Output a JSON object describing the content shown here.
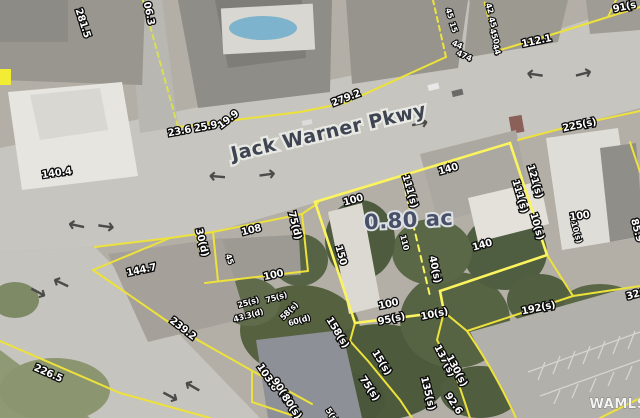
{
  "map": {
    "road_label": "Jack Warner Pkwy",
    "highlight_parcel": {
      "area_label": "0.80 ac"
    },
    "watermark": "WAMLS",
    "arrow_glyph": "→",
    "colors": {
      "parcel_line": "#EDE23B",
      "highlight_parcel_line": "#FBF45F",
      "area_text": "#475066",
      "road_text": "#3E4452",
      "dimension_text_fill": "#FFFFFF",
      "dimension_text_outline": "#0B0B0B"
    },
    "label_sizes": {
      "dim": 10,
      "dimsm": 8,
      "road": 19,
      "area": 21,
      "wm": 13
    },
    "labels": [
      {
        "t": "281.5",
        "x": 80,
        "y": 24,
        "r": 72,
        "k": "dim"
      },
      {
        "t": "06.3",
        "x": 146,
        "y": 14,
        "r": 78,
        "k": "dim"
      },
      {
        "t": "23.6 25.9",
        "x": 193,
        "y": 132,
        "r": -10,
        "k": "dim"
      },
      {
        "t": "19.9",
        "x": 230,
        "y": 122,
        "r": -38,
        "k": "dim"
      },
      {
        "t": "140.4",
        "x": 57,
        "y": 176,
        "r": -8,
        "k": "dim"
      },
      {
        "t": "279.2",
        "x": 347,
        "y": 101,
        "r": -21,
        "k": "dim"
      },
      {
        "t": "112.1",
        "x": 537,
        "y": 44,
        "r": -12,
        "k": "dim"
      },
      {
        "t": "91(s",
        "x": 625,
        "y": 10,
        "r": -12,
        "k": "dim"
      },
      {
        "t": "45",
        "x": 447,
        "y": 14,
        "r": 72,
        "k": "dimsm"
      },
      {
        "t": "15",
        "x": 451,
        "y": 28,
        "r": 72,
        "k": "dimsm"
      },
      {
        "t": "44",
        "x": 456,
        "y": 47,
        "r": 25,
        "k": "dimsm"
      },
      {
        "t": "474",
        "x": 463,
        "y": 58,
        "r": 25,
        "k": "dimsm"
      },
      {
        "t": "42",
        "x": 487,
        "y": 9,
        "r": 72,
        "k": "dimsm"
      },
      {
        "t": "45",
        "x": 490,
        "y": 23,
        "r": 72,
        "k": "dimsm"
      },
      {
        "t": "450",
        "x": 492,
        "y": 37,
        "r": 72,
        "k": "dimsm"
      },
      {
        "t": "44",
        "x": 494,
        "y": 50,
        "r": 72,
        "k": "dimsm"
      },
      {
        "t": "225(s)",
        "x": 580,
        "y": 128,
        "r": -12,
        "k": "dim"
      },
      {
        "t": "100",
        "x": 580,
        "y": 219,
        "r": -8,
        "k": "dim"
      },
      {
        "t": "85.9",
        "x": 634,
        "y": 231,
        "r": 75,
        "k": "dim"
      },
      {
        "t": "111(s)",
        "x": 407,
        "y": 192,
        "r": 74,
        "k": "dim"
      },
      {
        "t": "111(s)",
        "x": 517,
        "y": 197,
        "r": 74,
        "k": "dim"
      },
      {
        "t": "121(s)",
        "x": 532,
        "y": 182,
        "r": 74,
        "k": "dim"
      },
      {
        "t": "140",
        "x": 449,
        "y": 172,
        "r": -16,
        "k": "dim"
      },
      {
        "t": "100",
        "x": 354,
        "y": 203,
        "r": -16,
        "k": "dim"
      },
      {
        "t": "0.80 ac",
        "x": 409,
        "y": 227,
        "r": -3,
        "k": "area"
      },
      {
        "t": "110",
        "x": 402,
        "y": 243,
        "r": 76,
        "k": "dimsm"
      },
      {
        "t": "150",
        "x": 338,
        "y": 256,
        "r": 74,
        "k": "dim"
      },
      {
        "t": "140",
        "x": 483,
        "y": 248,
        "r": -16,
        "k": "dim"
      },
      {
        "t": "40(s)",
        "x": 432,
        "y": 270,
        "r": 78,
        "k": "dim"
      },
      {
        "t": "10(s)",
        "x": 534,
        "y": 227,
        "r": 74,
        "k": "dim"
      },
      {
        "t": "10(s)",
        "x": 574,
        "y": 233,
        "r": 74,
        "k": "dimsm"
      },
      {
        "t": "100",
        "x": 389,
        "y": 307,
        "r": -12,
        "k": "dim"
      },
      {
        "t": "95(s)",
        "x": 392,
        "y": 322,
        "r": -12,
        "k": "dim"
      },
      {
        "t": "10(s)",
        "x": 435,
        "y": 317,
        "r": -12,
        "k": "dim"
      },
      {
        "t": "192(s)",
        "x": 539,
        "y": 311,
        "r": -12,
        "k": "dim"
      },
      {
        "t": "326",
        "x": 637,
        "y": 297,
        "r": -16,
        "k": "dim"
      },
      {
        "t": "30(d)",
        "x": 199,
        "y": 243,
        "r": 76,
        "k": "dim"
      },
      {
        "t": "108",
        "x": 252,
        "y": 233,
        "r": -14,
        "k": "dim"
      },
      {
        "t": "75(d)",
        "x": 292,
        "y": 226,
        "r": 76,
        "k": "dim"
      },
      {
        "t": "45",
        "x": 227,
        "y": 260,
        "r": 70,
        "k": "dimsm"
      },
      {
        "t": "100",
        "x": 274,
        "y": 278,
        "r": -12,
        "k": "dim"
      },
      {
        "t": "25(s)",
        "x": 249,
        "y": 305,
        "r": -16,
        "k": "dimsm"
      },
      {
        "t": "75(s)",
        "x": 277,
        "y": 300,
        "r": -16,
        "k": "dimsm"
      },
      {
        "t": "43.3(d)",
        "x": 249,
        "y": 318,
        "r": -16,
        "k": "dimsm"
      },
      {
        "t": "58(s)",
        "x": 291,
        "y": 313,
        "r": -45,
        "k": "dimsm"
      },
      {
        "t": "60(d)",
        "x": 300,
        "y": 323,
        "r": -16,
        "k": "dimsm"
      },
      {
        "t": "144.7",
        "x": 142,
        "y": 273,
        "r": -12,
        "k": "dim"
      },
      {
        "t": "239.2",
        "x": 181,
        "y": 331,
        "r": 38,
        "k": "dim"
      },
      {
        "t": "226.5",
        "x": 47,
        "y": 376,
        "r": 24,
        "k": "dim"
      },
      {
        "t": "103.6",
        "x": 265,
        "y": 379,
        "r": 56,
        "k": "dim"
      },
      {
        "t": "90(s)",
        "x": 279,
        "y": 392,
        "r": 56,
        "k": "dim"
      },
      {
        "t": "80(s)",
        "x": 289,
        "y": 408,
        "r": 56,
        "k": "dim"
      },
      {
        "t": "158(s)",
        "x": 335,
        "y": 334,
        "r": 58,
        "k": "dim"
      },
      {
        "t": "15(s)",
        "x": 379,
        "y": 364,
        "r": 58,
        "k": "dim"
      },
      {
        "t": "75(s)",
        "x": 367,
        "y": 390,
        "r": 56,
        "k": "dim"
      },
      {
        "t": "137(s)",
        "x": 442,
        "y": 362,
        "r": 62,
        "k": "dim"
      },
      {
        "t": "130(s)",
        "x": 454,
        "y": 372,
        "r": 62,
        "k": "dim"
      },
      {
        "t": "135(s)",
        "x": 425,
        "y": 394,
        "r": 76,
        "k": "dim"
      },
      {
        "t": "92.6",
        "x": 451,
        "y": 405,
        "r": 56,
        "k": "dim"
      },
      {
        "t": "5(s)",
        "x": 330,
        "y": 417,
        "r": 56,
        "k": "dimsm"
      },
      {
        "t": "Jack Warner Pkwy",
        "x": 330,
        "y": 138,
        "r": -13,
        "k": "road"
      },
      {
        "t": "WAMLS",
        "x": 618,
        "y": 408,
        "r": 0,
        "k": "wm"
      }
    ],
    "arrows": [
      {
        "x": 218,
        "y": 170,
        "r": 185
      },
      {
        "x": 268,
        "y": 181,
        "r": -8
      },
      {
        "x": 421,
        "y": 130,
        "r": -12
      },
      {
        "x": 536,
        "y": 68,
        "r": 188
      },
      {
        "x": 585,
        "y": 80,
        "r": -15
      },
      {
        "x": 78,
        "y": 219,
        "r": 192
      },
      {
        "x": 105,
        "y": 233,
        "r": 8
      },
      {
        "x": 64,
        "y": 277,
        "r": -155
      },
      {
        "x": 35,
        "y": 298,
        "r": 28
      },
      {
        "x": 196,
        "y": 381,
        "r": -150
      },
      {
        "x": 167,
        "y": 402,
        "r": 28
      }
    ]
  }
}
